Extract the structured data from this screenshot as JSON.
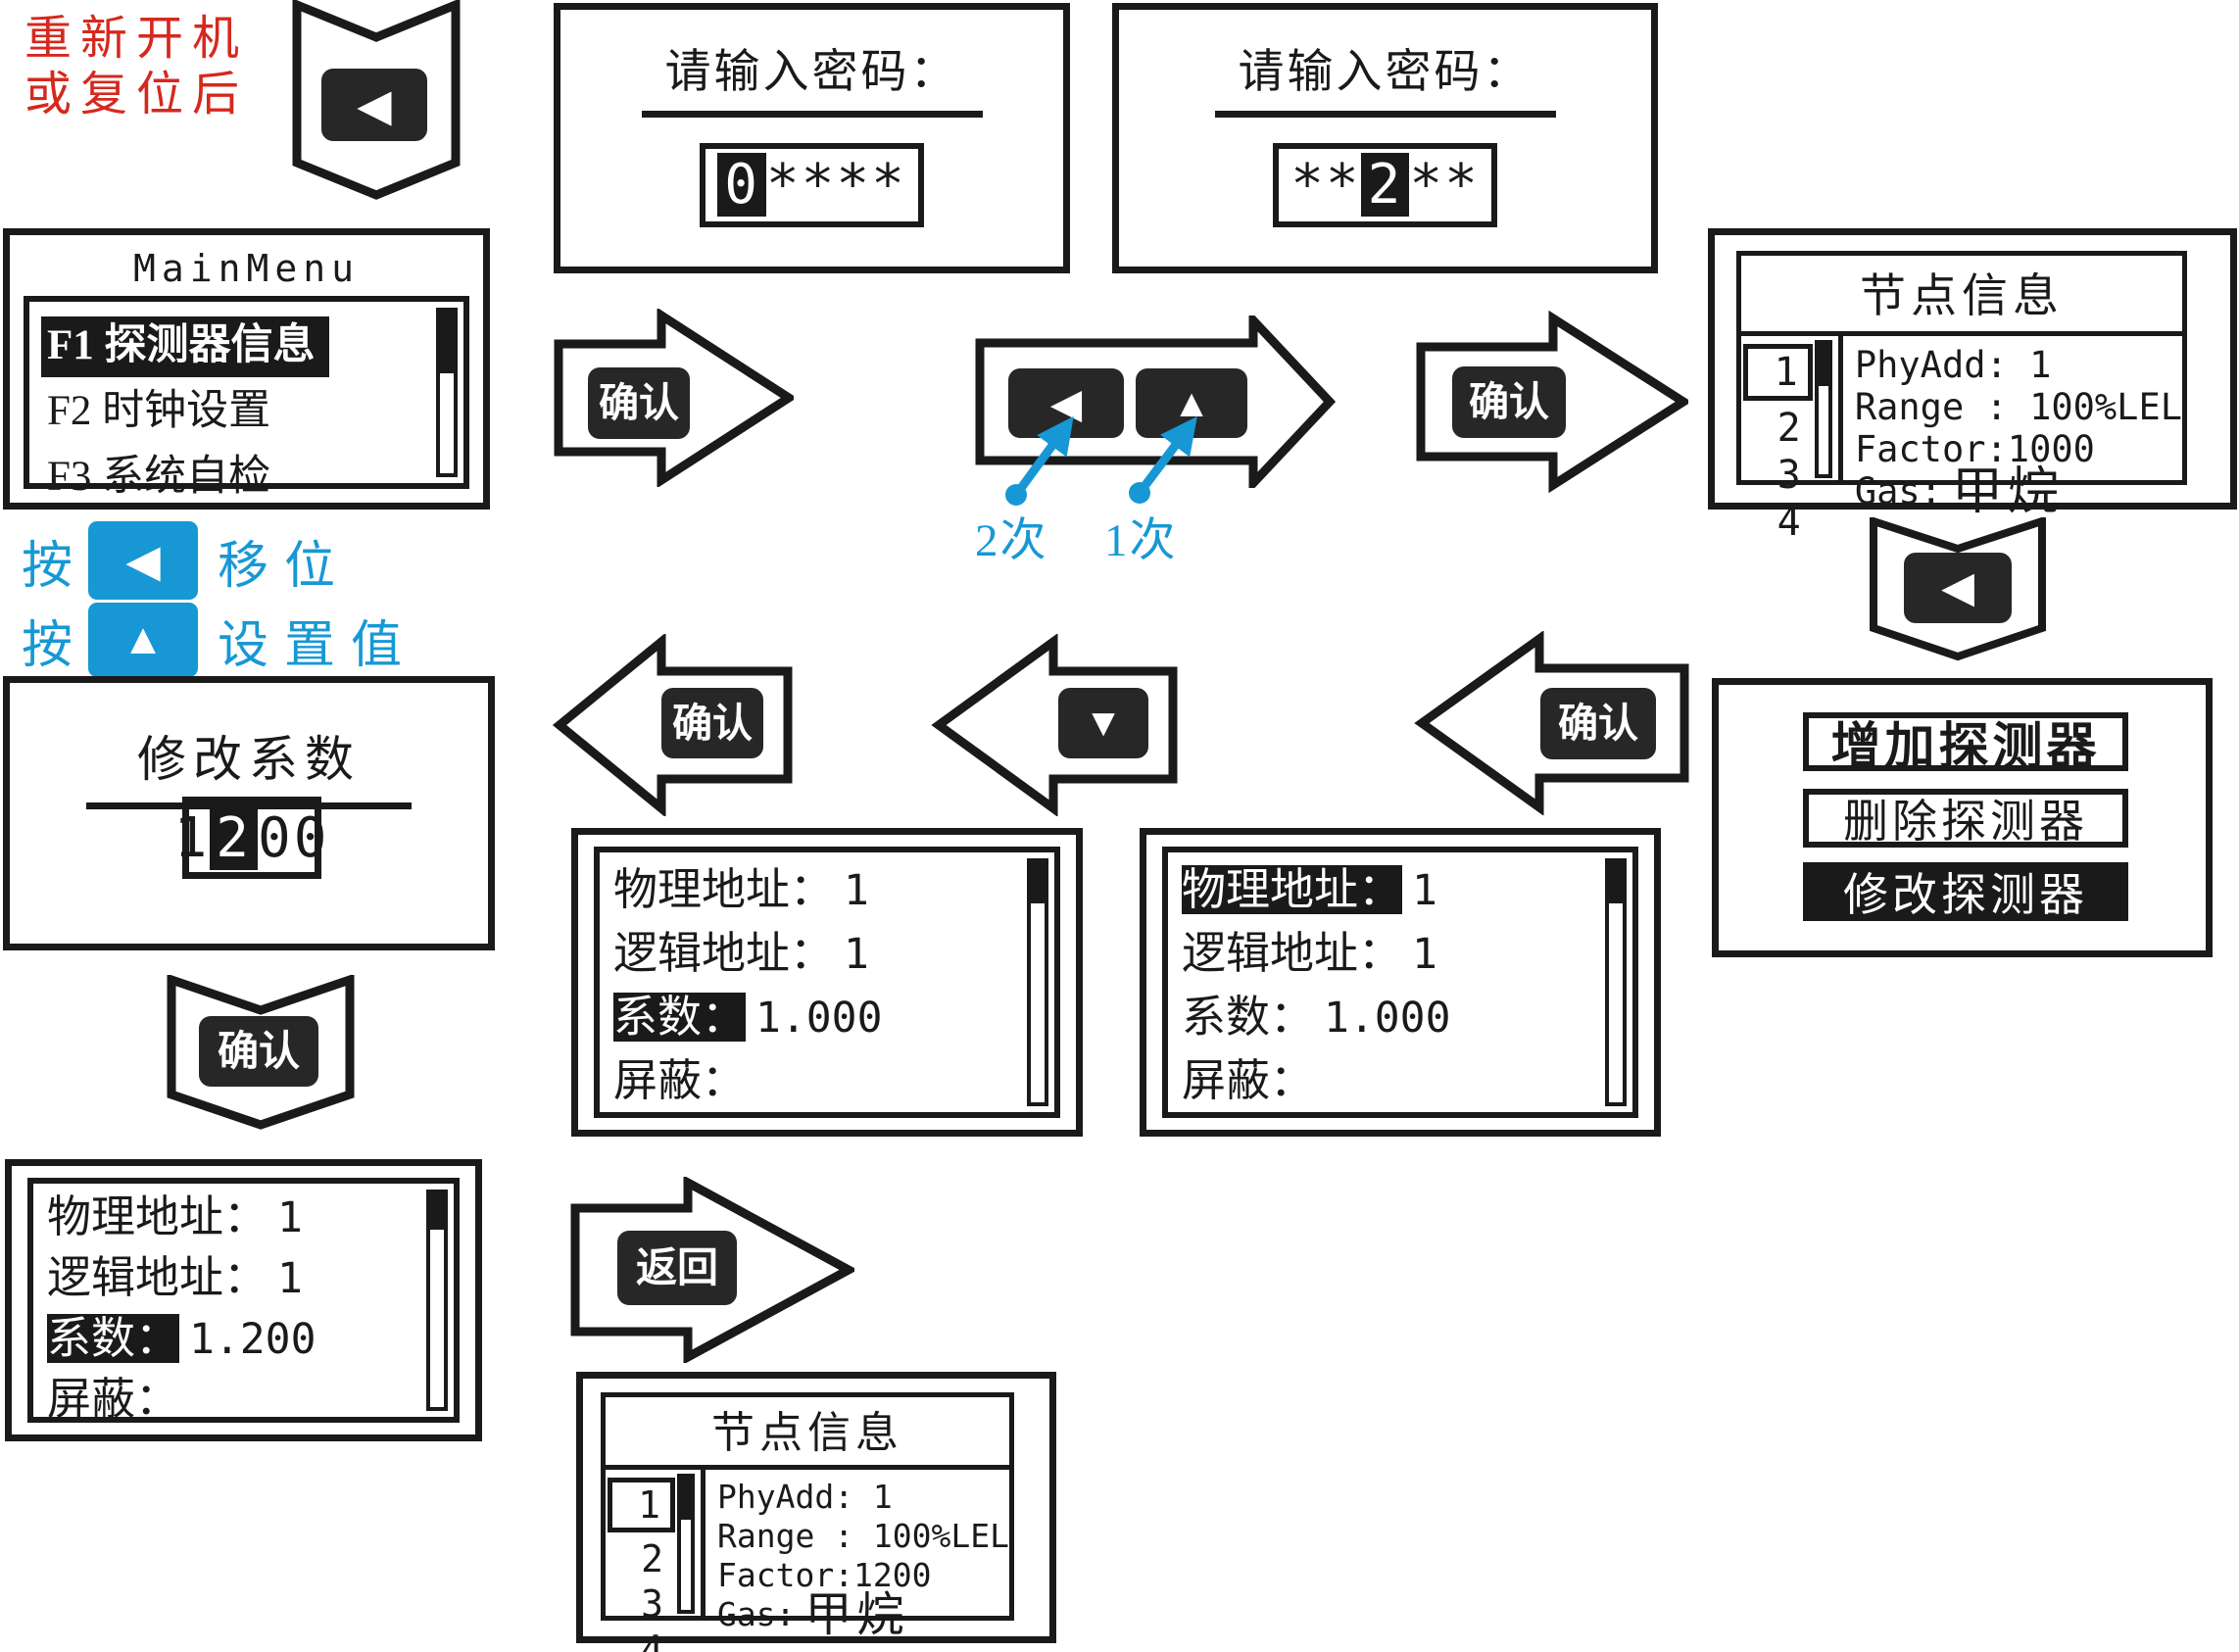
{
  "colors": {
    "ink": "#1a1a1a",
    "key_fill": "#272727",
    "red_note": "#d6281e",
    "blue_hint": "#1798d5"
  },
  "restart_note": {
    "line1": "重新开机",
    "line2": "或复位后"
  },
  "keys": {
    "left": "◀",
    "up": "▲",
    "down": "▼",
    "confirm": "确认",
    "back": "返回"
  },
  "hints": {
    "press_shift_prefix": "按",
    "shift_label": "移位",
    "press_set_prefix": "按",
    "set_label": "设置值",
    "left_times": "2次",
    "up_times": "1次"
  },
  "screens": {
    "password_first": {
      "title": "请输入密码：",
      "value_pre": "",
      "value_sel": "0",
      "value_post": "****"
    },
    "password_second": {
      "title": "请输入密码：",
      "value_pre": "**",
      "value_sel": "2",
      "value_post": "**"
    },
    "main_menu": {
      "title": "MainMenu",
      "items": [
        {
          "label": "F1 探测器信息",
          "selected": true
        },
        {
          "label": "F2 时钟设置",
          "selected": false
        },
        {
          "label": "F3 系统自检",
          "selected": false
        }
      ]
    },
    "node_info_before": {
      "title": "节点信息",
      "list": [
        "1",
        "2",
        "3",
        "4"
      ],
      "selected_index": 0,
      "lines": [
        "PhyAdd: 1",
        "Range : 100%LEL",
        "Factor:1000"
      ],
      "gas_label": "Gas:",
      "gas_value": "甲烷"
    },
    "detector_menu": {
      "items": [
        {
          "label": "增加探测器",
          "selected": false
        },
        {
          "label": "删除探测器",
          "selected": false
        },
        {
          "label": "修改探测器",
          "selected": true
        }
      ]
    },
    "detail_phys_selected": {
      "rows": [
        {
          "label": "物理地址：",
          "value": "1",
          "selected": true
        },
        {
          "label": "逻辑地址：",
          "value": "1",
          "selected": false
        },
        {
          "label": "系数：",
          "value": "1.000",
          "selected": false
        },
        {
          "label": "屏蔽：",
          "value": "",
          "selected": false
        }
      ]
    },
    "detail_factor_selected": {
      "rows": [
        {
          "label": "物理地址：",
          "value": "1",
          "selected": false
        },
        {
          "label": "逻辑地址：",
          "value": "1",
          "selected": false
        },
        {
          "label": "系数：",
          "value": "1.000",
          "selected": true
        },
        {
          "label": "屏蔽：",
          "value": "",
          "selected": false
        }
      ]
    },
    "edit_factor": {
      "title": "修改系数",
      "value_pre": "1",
      "value_sel": "2",
      "value_post": "00"
    },
    "detail_factor_updated": {
      "rows": [
        {
          "label": "物理地址：",
          "value": "1",
          "selected": false
        },
        {
          "label": "逻辑地址：",
          "value": "1",
          "selected": false
        },
        {
          "label": "系数：",
          "value": "1.200",
          "selected": true
        },
        {
          "label": "屏蔽：",
          "value": "",
          "selected": false
        }
      ]
    },
    "node_info_after": {
      "title": "节点信息",
      "list": [
        "1",
        "2",
        "3",
        "4"
      ],
      "selected_index": 0,
      "lines": [
        "PhyAdd: 1",
        "Range : 100%LEL",
        "Factor:1200"
      ],
      "gas_label": "Gas:",
      "gas_value": "甲烷"
    }
  }
}
